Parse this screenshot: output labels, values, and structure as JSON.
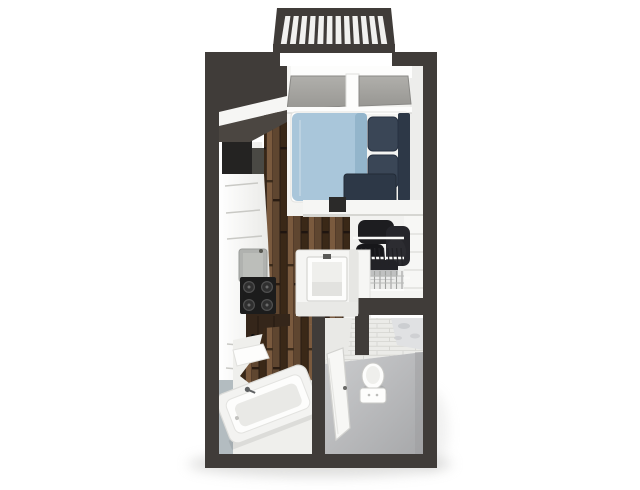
{
  "scene": {
    "type": "3d-floor-plan",
    "view": "top-down-render",
    "unit": "studio-apartment",
    "visible_text": ""
  },
  "palette": {
    "background": "#ffffff",
    "wall_dark": "#403c39",
    "wall_medium": "#4b4641",
    "interior_white": "#f6f6f4",
    "white_bright": "#fdfdfc",
    "shade_light": "#e8e8e5",
    "shade_mid": "#d6d6d2",
    "wood_base": "#4e3a28",
    "wood_dark": "#3122167",
    "wood_deep": "#2a1c12",
    "wood_mid": "#5f4630",
    "wood_light": "#7a5a3e",
    "duvet_blue": "#a9c6da",
    "duvet_blue_shade": "#93b5cb",
    "navy": "#3a4656",
    "navy_dark": "#2d3847",
    "glass_gray": "#a3a29e",
    "appliance_dark": "#242322",
    "cooktop_black": "#1c1c1c",
    "sink_gray": "#b0b2af",
    "bath_floor_light": "#c6c7c9",
    "bath_floor_dark": "#aaabad",
    "tile_white": "#ebebe8",
    "tile_line": "#d7d7d3",
    "marble_base": "#e0e1e3",
    "marble_vein": "#c7c9cc",
    "wall_blue_gray": "#b3bcc0",
    "shadow": "#c4c4c2"
  },
  "fixtures": {
    "balcony": {
      "baluster_count": 13
    },
    "bedroom": [
      "sliding-glass-doors",
      "bed",
      "duvet",
      "pillows",
      "headboard",
      "foot-bench",
      "stool"
    ],
    "kitchen": [
      "refrigerator",
      "cabinets",
      "sink",
      "cooktop-4-burners",
      "lower-cabinet"
    ],
    "hallway": [
      "wood-plank-floor"
    ],
    "vanity": [
      "square-basin",
      "faucet"
    ],
    "closet": {
      "items": [
        "wire-shelving",
        "hanging-clothes",
        "wire-baskets"
      ],
      "hanger_tick_count": 11,
      "basket_bar_count": 9
    },
    "bathroom": [
      "toilet",
      "door",
      "subway-tile-wall",
      "marble-tile-corner"
    ],
    "tub_room": [
      "bathtub",
      "tub-faucet",
      "corner-shelf",
      "accent-wall"
    ]
  }
}
